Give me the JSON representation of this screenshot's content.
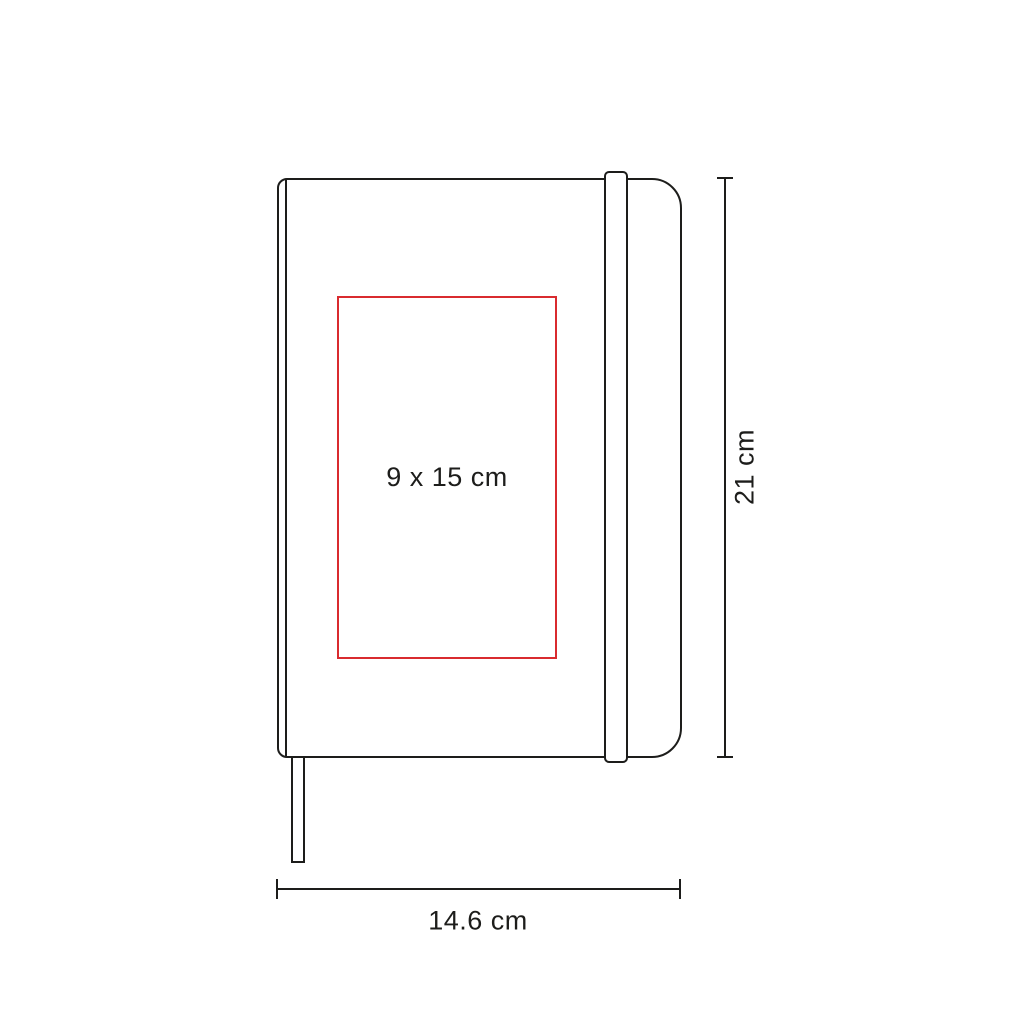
{
  "diagram": {
    "type": "product-dimension-diagram",
    "product": "hardcover-notebook-with-elastic-band-and-bookmark",
    "print_area_label": "9 x 15 cm",
    "height_label": "21 cm",
    "width_label": "14.6 cm",
    "colors": {
      "line": "#1d1d1b",
      "print_area": "#d92b2f",
      "background": "#ffffff"
    }
  }
}
